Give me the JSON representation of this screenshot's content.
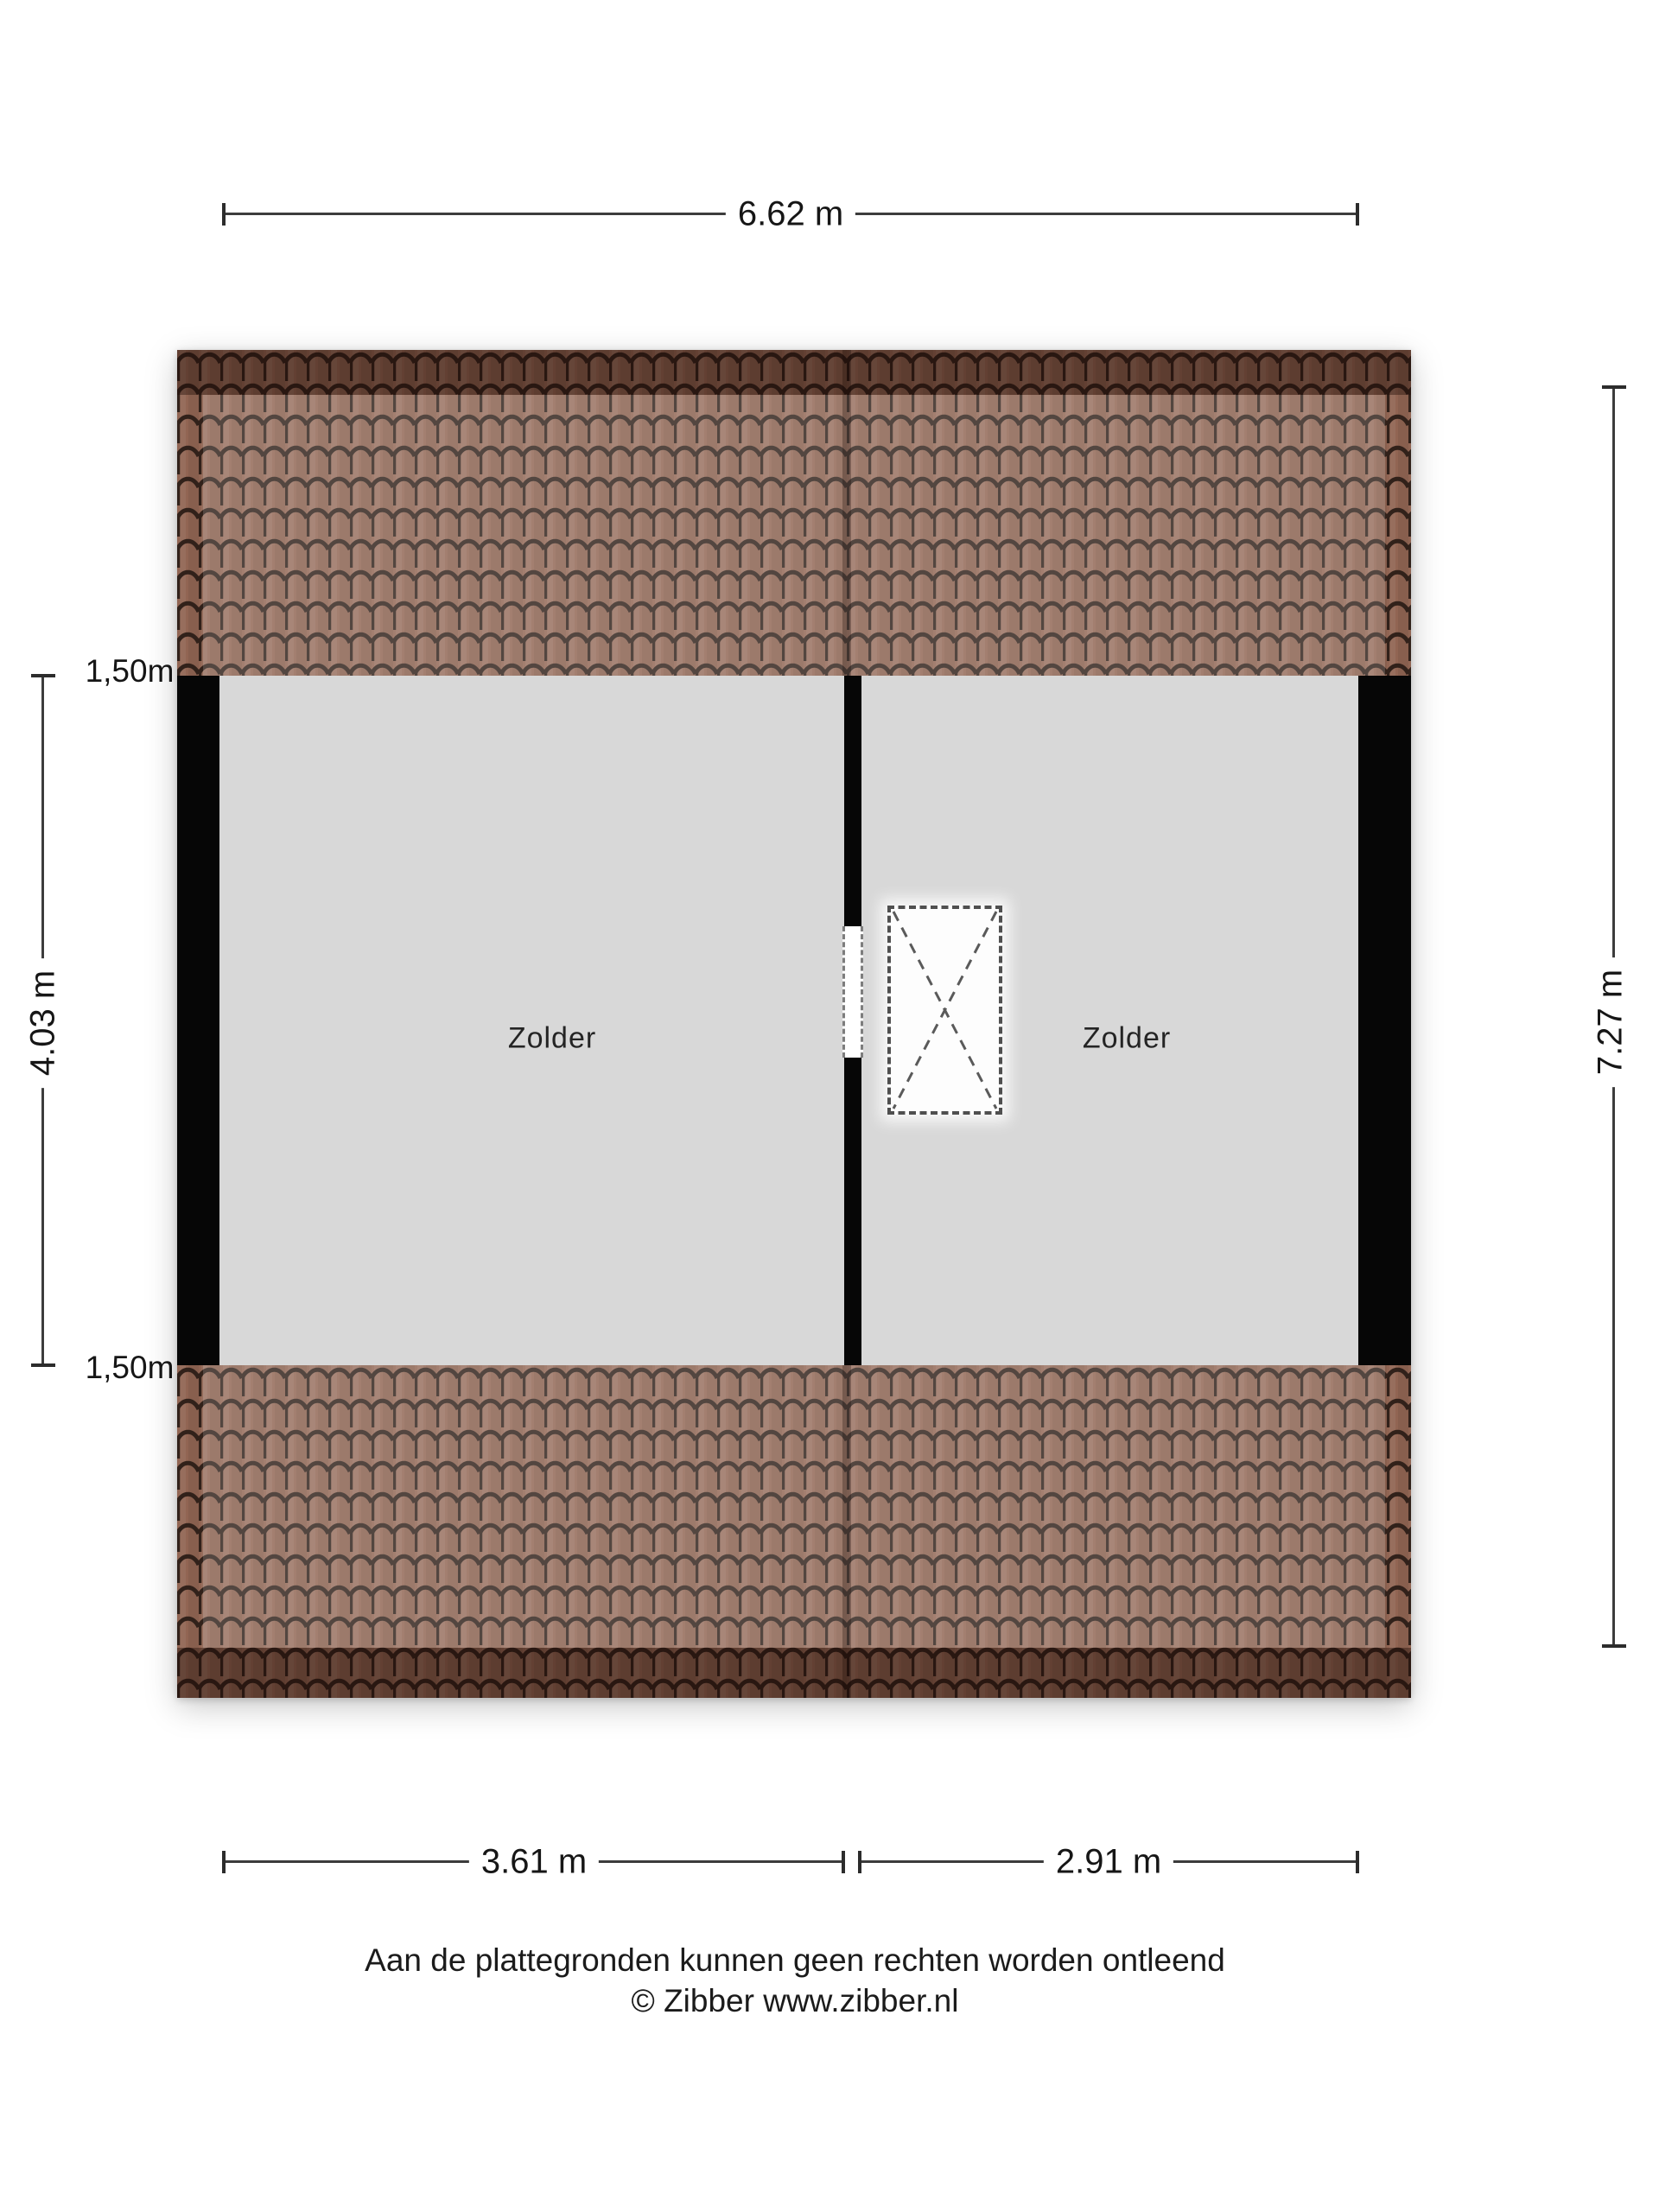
{
  "page": {
    "background": "#ffffff"
  },
  "plan": {
    "rooms": [
      {
        "label": "Zolder"
      },
      {
        "label": "Zolder"
      }
    ],
    "dimensions": {
      "total_width": "6.62 m",
      "total_depth": "7.27 m",
      "inner_height": "4.03 m",
      "knee_wall_top": "1,50m",
      "knee_wall_bottom": "1,50m",
      "room_left_width": "3.61 m",
      "room_right_width": "2.91 m"
    },
    "colors": {
      "floor": "#d8d8d8",
      "wall": "#060606",
      "roof_tile": "#916553",
      "roof_joint": "#31211a",
      "dimension_line": "#3c3c3c"
    }
  },
  "footer": {
    "disclaimer": "Aan de plattegronden kunnen geen rechten worden ontleend",
    "copyright": "© Zibber www.zibber.nl"
  }
}
